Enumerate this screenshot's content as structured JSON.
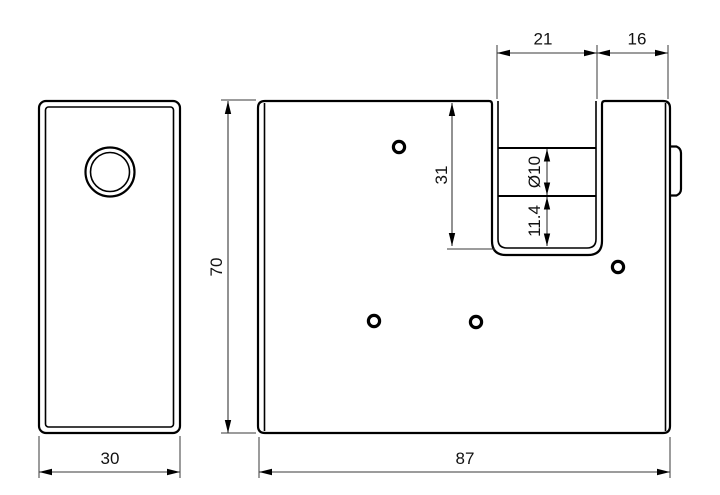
{
  "drawing": {
    "type": "technical-dimension-drawing",
    "views": {
      "side_view": "padlock-side-profile-with-keyhole",
      "front_view": "padlock-front-with-shackle-notch"
    },
    "dimensions": {
      "notch_width": "21",
      "right_block_width": "16",
      "side_width": "30",
      "body_width": "87",
      "body_height": "70",
      "notch_depth": "31",
      "shackle_diameter": "Ø10",
      "notch_bottom_gap": "11.4"
    },
    "colors": {
      "background": "#ffffff",
      "outline": "#000000",
      "dimension_lines": "#3a3a3a",
      "text": "#111111"
    }
  }
}
